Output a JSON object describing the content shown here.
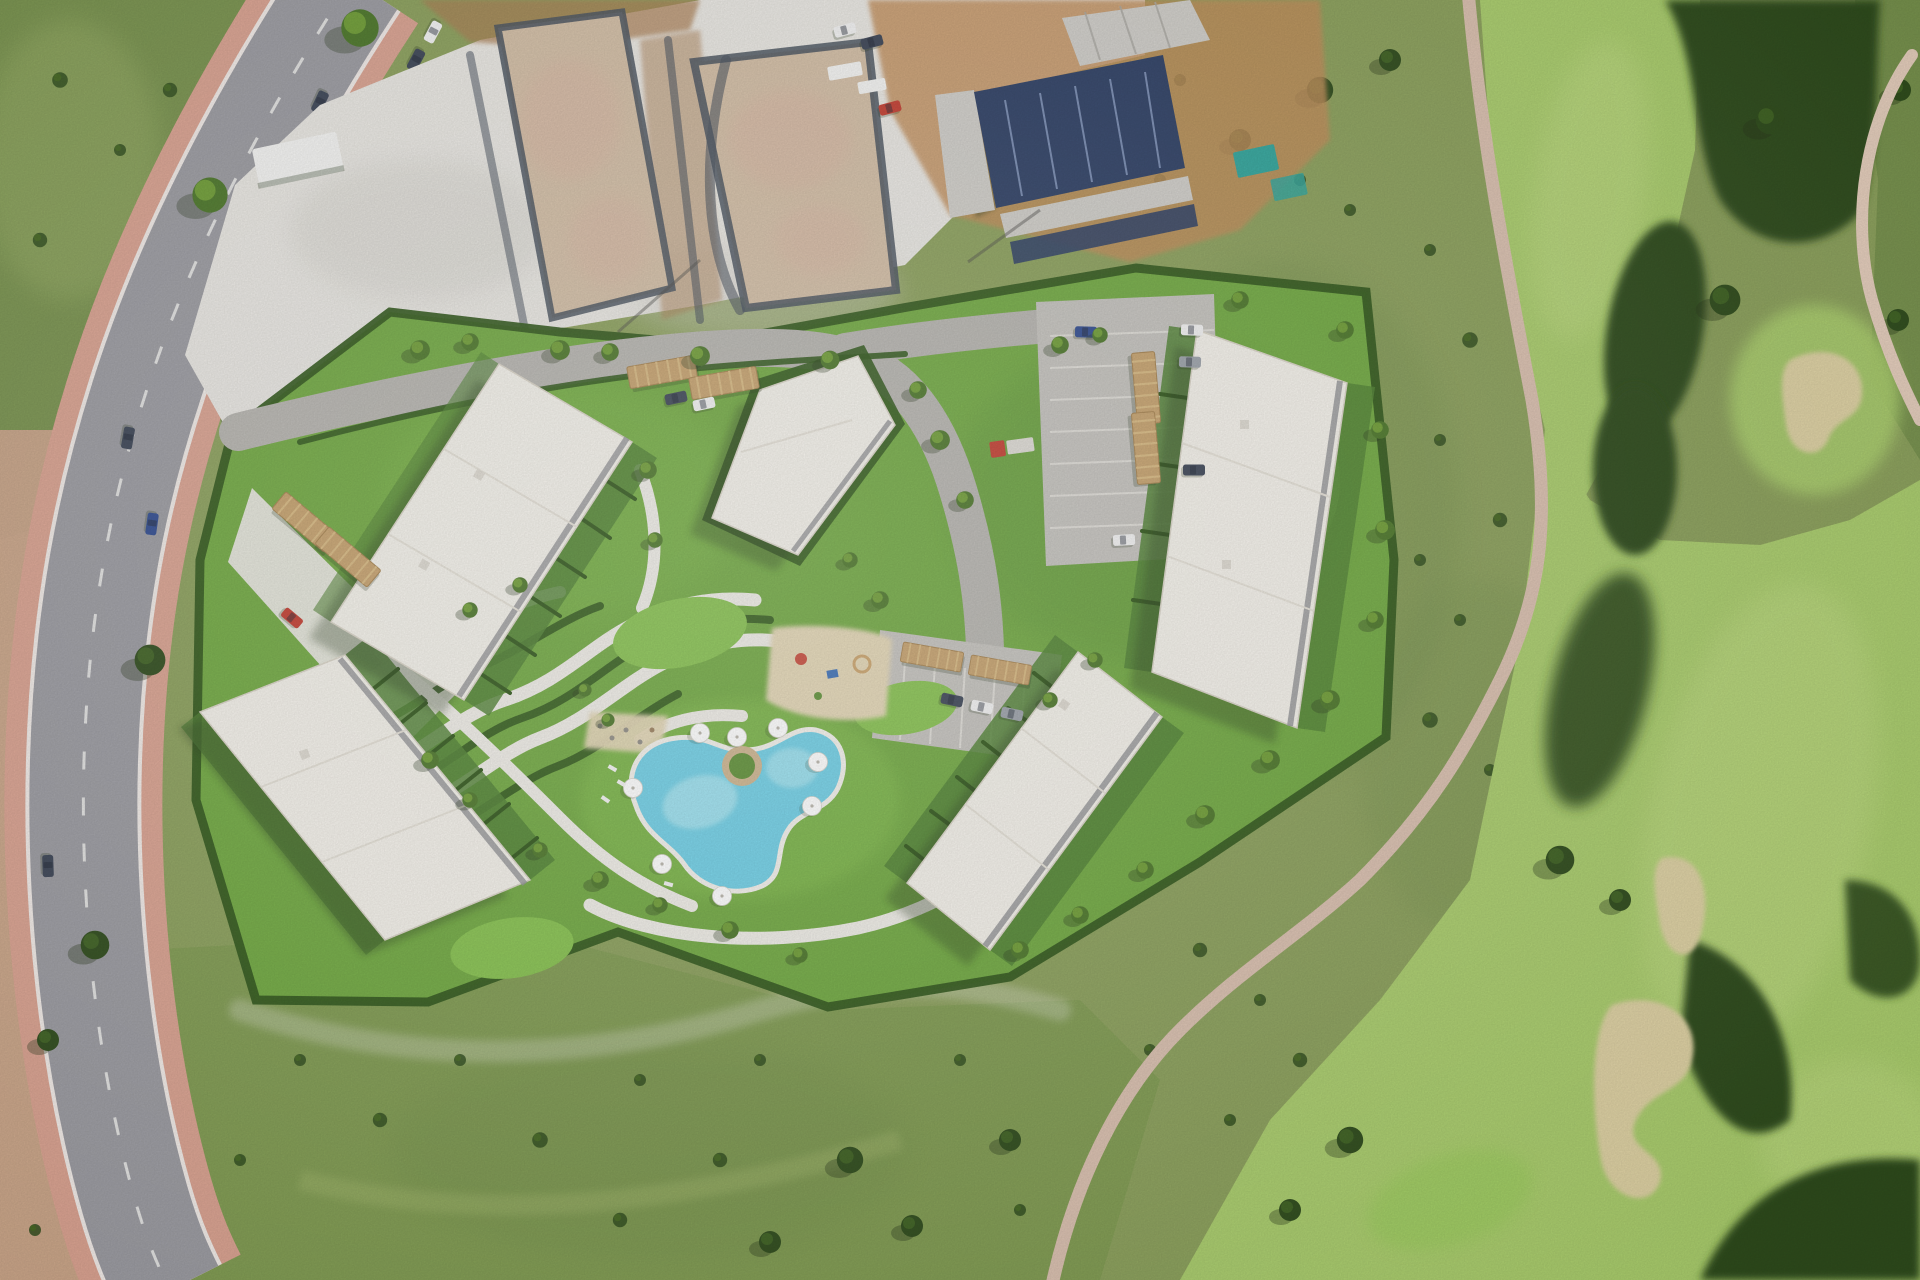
{
  "scene": {
    "type": "aerial-photograph",
    "description": "Aerial satellite view of a coastal residential development: five white flat-roofed apartment blocks set in landscaped gardens with winding paths, a kidney-shaped swimming pool with white parasols, a playground, parking areas with wooden carport pergolas, a construction zone with building foundations and a solar-panel roof to the north, a curving road with pink sidewalks and parked cars on the left, and a golf course with fairways, dark tree masses, sand bunkers and a pale cart path on the right.",
    "labels": {
      "surrounding_landscape": "Scrubland and meadow surrounding the site",
      "main_road": "Curving access road with pink sidewalks and parked cars",
      "construction_zone": "Construction area with two foundation plots and a building with dark solar-panel roof",
      "residential_development": "Rendered residential resort with five white apartment buildings and gardens",
      "swimming_pool": "Kidney-shaped swimming pool with parasols and island planter",
      "golf_course": "Golf course with fairways, tree belts, sand bunkers and cart paths"
    },
    "features": [
      "apartment-building x5",
      "swimming-pool",
      "pool-island-planter",
      "pool-umbrellas",
      "sun-loungers",
      "playground",
      "sand-plaza",
      "garden-ribbon-paths",
      "hedge-gardens",
      "putting-lawns",
      "carport-pergolas",
      "parking-lots",
      "red-truck",
      "red-car",
      "parked-cars",
      "construction-plot x2",
      "solar-roof-building",
      "site-trailers",
      "teal-containers",
      "main-road",
      "pink-sidewalks",
      "street-trees",
      "golf-fairways",
      "sand-bunkers",
      "cart-paths",
      "tree-belts"
    ]
  },
  "colors": {
    "scrub_base": "#8a9f5a",
    "scrub_dark": "#708c48",
    "scrub_light": "#a3b76c",
    "meadow": "#7e9a50",
    "lawn": "#6fa83f",
    "lawn_bright": "#85c14d",
    "lawn_dark": "#4e8030",
    "hedge": "#2f5619",
    "tree_dark": "#2e4b1b",
    "tree_mid": "#4a7527",
    "tree_light": "#6d9c33",
    "fairway": "#a9cc6c",
    "fairway_light": "#bdd981",
    "green_bright": "#9ccb5f",
    "bunker_sand": "#ddd0a2",
    "road_asphalt": "#9a9aa0",
    "road_line": "#f2f2f0",
    "sidewalk_pink": "#d9a18f",
    "dirt_pink": "#d4a48f",
    "gravel_white": "#e9e7e2",
    "gravel_shadow": "#cfcdc6",
    "site_road": "#b5b3ae",
    "parking": "#c3c1bc",
    "stall_line": "#e8e6e0",
    "path_white": "#efede7",
    "roof_white": "#f4f1ea",
    "roof_trim": "#d8d3c6",
    "roof_line": "#e4e0d6",
    "glass_dark": "#8f9092",
    "shadow": "#243418",
    "pool_water": "#6ecfe6",
    "pool_light": "#a9e6f2",
    "pool_rim": "#f3f1ec",
    "sand_play": "#e3d6b4",
    "pergola": "#c5a06b",
    "construction_tan": "#d2bda4",
    "construction_pink": "#d8b3a0",
    "trench_dark": "#47505c",
    "dirt_brown": "#a97c4f",
    "dirt_orange": "#c08b56",
    "navy_roof": "#2c3e63",
    "navy_line": "#8fa3c8",
    "concrete": "#cfcdc8",
    "teal_container": "#2fa39a",
    "car_red": "#c23b2e",
    "car_dark": "#3a4354",
    "car_white": "#f2f2f2",
    "car_gray": "#9aa0a8",
    "car_blue": "#2e4a8f",
    "car_teal": "#3f6e6e",
    "cart_path": "#d9bfae",
    "cart_path2": "#e4cdbb",
    "umbrella": "#ffffff",
    "planter_ring": "#cdb48e",
    "planter_green": "#5d8f35",
    "play_red": "#c74a3a",
    "play_blue": "#3b6fb5"
  }
}
